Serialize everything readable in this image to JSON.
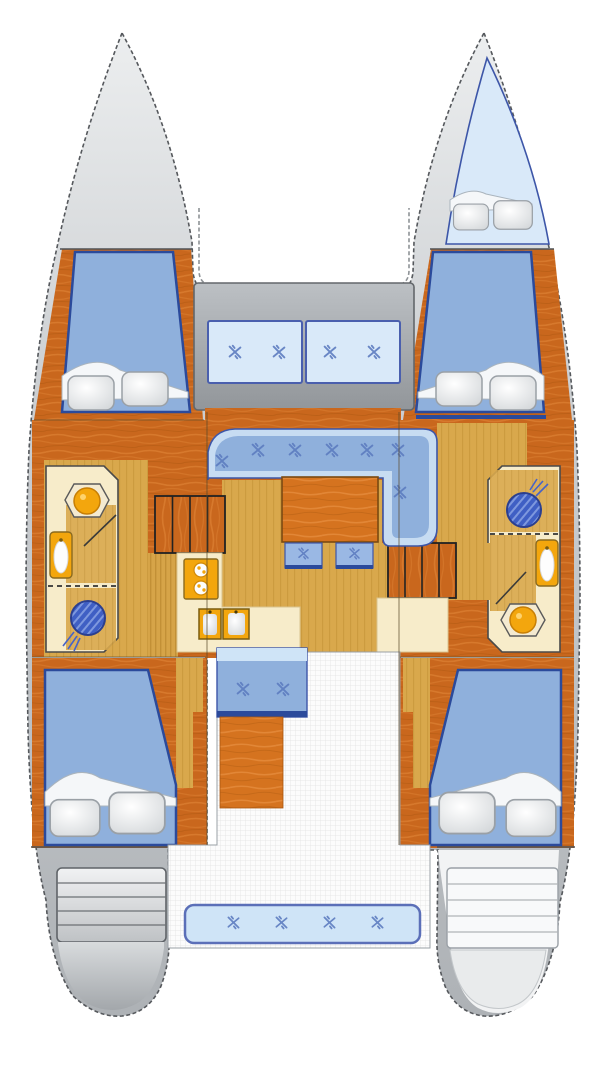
{
  "document": {
    "type": "boat-floor-plan",
    "vessel": "catamaran",
    "orientation": "bow-up",
    "view": "top-down deck and accommodation layout"
  },
  "colors": {
    "wood": "#c9671d",
    "woodLight": "#e2883a",
    "tableWood": "#d5731f",
    "gold": "#d9a84c",
    "cream": "#f7ecca",
    "bedBlue": "#8fb0dc",
    "navy": "#2b4a9b",
    "seatBackLight": "#c7dcf2",
    "cushionLight": "#d9e9f9",
    "cushionBorder": "#4a5fae",
    "benchLight": "#cfe4f7",
    "fixtureOrange": "#f3a60d",
    "showerBlue": "#3f5fc4",
    "markBlue": "#5d7cc0",
    "hullGray": "#c9ccd0",
    "deckGray": "#a8acb0",
    "outline": "#55585c",
    "white": "#ffffff"
  },
  "areas": [
    {
      "id": "port-bow-deck",
      "label": "port bow deck",
      "contents": []
    },
    {
      "id": "forepeak-berth-starboard",
      "label": "starboard forepeak berth",
      "pillows": 2
    },
    {
      "id": "trampoline",
      "label": "foredeck trampoline"
    },
    {
      "id": "forward-cockpit",
      "label": "forward cockpit",
      "cushions": 2,
      "seat_marks_per_cushion": 2
    },
    {
      "id": "port-forward-cabin",
      "label": "port forward double cabin",
      "pillows": 2
    },
    {
      "id": "starboard-forward-cabin",
      "label": "starboard forward double cabin",
      "pillows": 2
    },
    {
      "id": "port-head",
      "label": "port bathroom",
      "fixtures": [
        "toilet",
        "sink",
        "shower"
      ]
    },
    {
      "id": "starboard-head",
      "label": "starboard bathroom",
      "fixtures": [
        "shower",
        "sink",
        "toilet"
      ]
    },
    {
      "id": "galley",
      "label": "galley",
      "fixtures": [
        "two-burner stove",
        "double sink"
      ]
    },
    {
      "id": "salon",
      "label": "salon settee",
      "seat_marks": 7,
      "table": 1
    },
    {
      "id": "stools",
      "label": "salon stools",
      "count": 2,
      "seat_marks_each": 1
    },
    {
      "id": "companionway-port",
      "label": "port companionway steps",
      "treads": 4
    },
    {
      "id": "companionway-starboard",
      "label": "starboard companionway steps",
      "treads": 4
    },
    {
      "id": "nav-desk",
      "label": "starboard desk"
    },
    {
      "id": "aft-bench",
      "label": "cockpit forward bench",
      "seat_marks": 2
    },
    {
      "id": "cockpit-table",
      "label": "cockpit table"
    },
    {
      "id": "cockpit-floor",
      "label": "cockpit grid floor"
    },
    {
      "id": "port-aft-cabin",
      "label": "port aft double cabin",
      "pillows": 2
    },
    {
      "id": "starboard-aft-cabin",
      "label": "starboard aft double cabin",
      "pillows": 2
    },
    {
      "id": "stern-bench",
      "label": "aft cockpit bench",
      "seat_marks": 4
    },
    {
      "id": "port-transom-steps",
      "label": "port transom steps",
      "treads": 5
    },
    {
      "id": "starboard-transom-steps",
      "label": "starboard transom steps",
      "treads": 5
    }
  ],
  "totals": {
    "double_cabins": 4,
    "forepeak_berths": 1,
    "heads": 2,
    "salon_seat_marks": 7,
    "cockpit_seat_marks": 10,
    "stool_seat_marks": 2,
    "total_seat_marks": 19
  }
}
